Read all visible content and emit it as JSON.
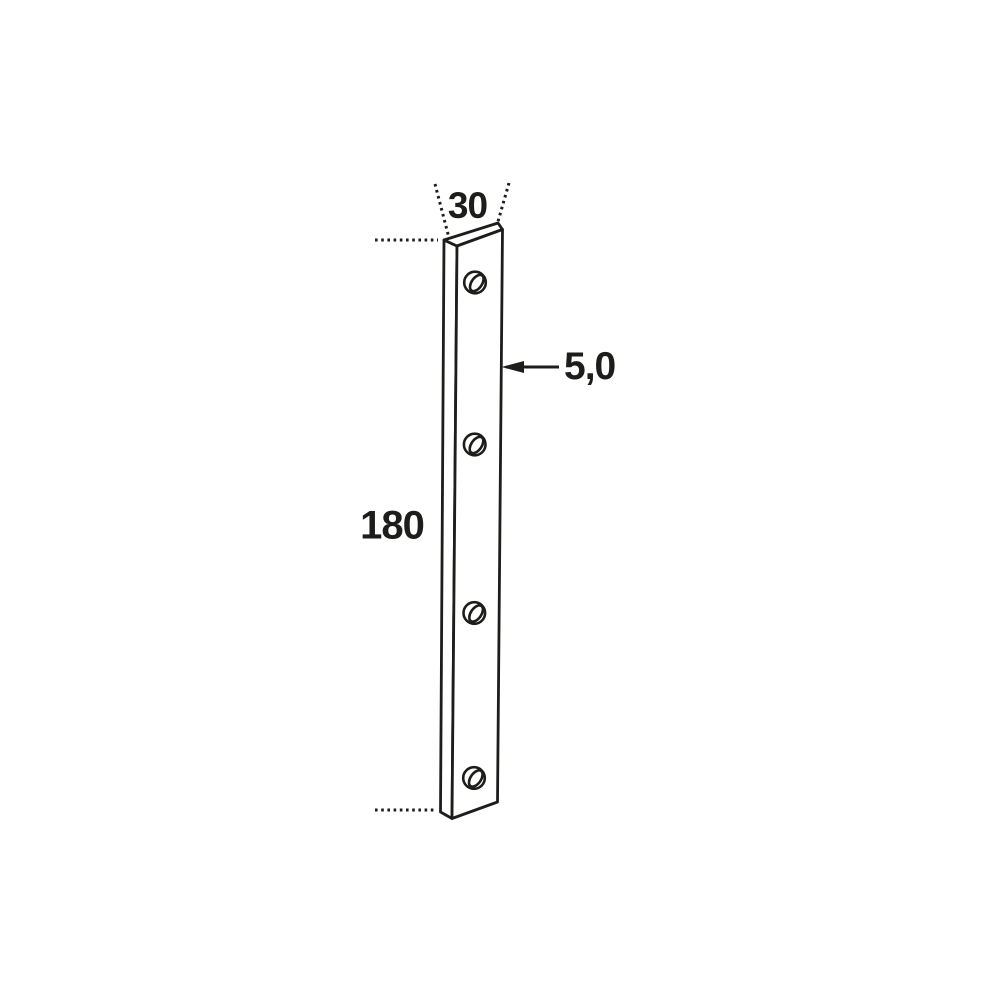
{
  "page": {
    "background_color": "#ffffff"
  },
  "drawing": {
    "description": "Technical dimension drawing of a flat connecting plate with four round holes, shown in slight perspective",
    "line_color": "#1d1d1b",
    "hole_count": 4,
    "labels": {
      "width": "30",
      "thickness": "5,0",
      "length": "180"
    }
  }
}
